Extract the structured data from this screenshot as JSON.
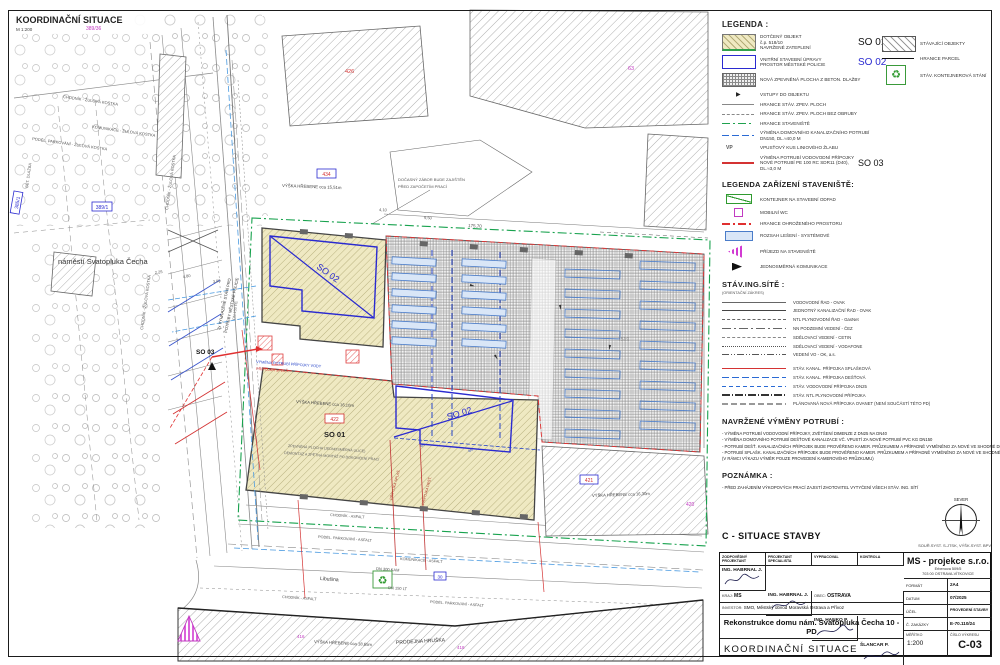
{
  "sheet": {
    "title": "KOORDINAČNÍ SITUACE",
    "scale": "M 1:200"
  },
  "icons": {
    "recycle": "♻",
    "entry_arrow": "▶"
  },
  "plan": {
    "labels": {
      "p389_36": "389/36",
      "p385_1": "385/1",
      "p389_1": "389/1",
      "p426": "426",
      "p434": "434",
      "p63": "63",
      "p422": "422",
      "p421": "421",
      "p420": "420",
      "p1519": "1519",
      "p416": "416",
      "p418": "418",
      "p30": "30",
      "chodnik_zk": "CHODNÍK - ŽULOVÁ KOSTKA",
      "komunikace_zk": "KOMUNIKACE - ŽULOVÁ KOSTKA",
      "podel_zk": "PODÉL. PARKOVÁNÍ - ŽULOVÁ KOSTKA",
      "bet_dlazba": "BET. DLAŽBA",
      "namesti": "náměstí Svatopluka Čecha",
      "vyhraz1": "2x VYHRAZENÉ STÁNÍ PRO",
      "vyhraz2": "POTŘEBY MĚSTSKÉ POLICIE",
      "so01": "SO 01",
      "so02": "SO 02",
      "so03": "SO 03",
      "vyska15": "VÝŠKA HŘEBENE cca 15,51m",
      "vyska16_10": "VÝŠKA HŘEBENE cca 16,10m",
      "vyska16_30": "VÝŠKA HŘEBENE cca 16,30m",
      "vyska18": "VÝŠKA HŘEBENE cca 18,65m",
      "prodejna": "PRODEJNA HRUŠKA",
      "docasny1": "DOČASNÝ ZÁBOR BUDE ZAJIŠTĚN",
      "docasny2": "PŘED ZAPOČETÍM PRACÍ",
      "vymena_vody": "VÝMĚNA POTRUBÍ PŘÍPOJKY VODY",
      "pripojka_splas": "PŘÍPOJKA SPLAŠ.",
      "pripojka_dest": "PŘÍPOJKA DEŠŤ.",
      "zpevnena1": "ZPEVNĚNÁ PLOCHA (JEDNOSMĚRNÁ ULICE)",
      "zpevnena2": "DEMONTÁŽ A ZPĚTNÁ MONTÁŽ PO DOKONČENÍ PRACÍ",
      "chodnik_asf": "CHODNÍK - ASFALT",
      "podel_asf": "PODÉL. PARKOVÁNÍ - ASFALT",
      "komunikace_asf": "KOMUNIKACE - ASFALT",
      "libusina": "Libušina",
      "dn300": "DN 300 KAM",
      "dn150": "DN 150 LT",
      "dn150pe": "DN 150 PE",
      "vp": "VP",
      "d410": "4,10",
      "d950": "9,50",
      "d17570": "175,70",
      "d225": "2,25",
      "d480": "4,80",
      "d300": "3,00"
    }
  },
  "legend": {
    "title": "LEGENDA :",
    "left": [
      {
        "l1": "DOTČENÝ OBJEKT",
        "l2": "č.p. 518/10",
        "l3": "NAVRŽENÉ ZATEPLENÍ",
        "tag": "SO 01"
      },
      {
        "l1": "VNITŘNÍ STAVEBNÍ ÚPRAVY",
        "l2": "PROSTOR MĚSTSKÉ POLICIE",
        "tag": "SO 02"
      },
      {
        "l1": "NOVÁ ZPEVNĚNÁ PLOCHA Z BETON. DLAŽBY"
      },
      {
        "l1": "VSTUPY DO OBJEKTU"
      },
      {
        "l1": "HRANICE STÁV. ZPEV. PLOCH"
      },
      {
        "l1": "HRANICE STÁV. ZPEV. PLOCH BEZ OBRUBY"
      },
      {
        "l1": "HRANICE STAVENIŠTĚ"
      },
      {
        "l1": "VÝMĚNA DOMOVNÍHO KANALIZAČNÍHO POTRUBÍ",
        "l2": "DN150, DL.≈40,0 M"
      },
      {
        "l1": "VPUSŤOVÝ KUS LINIOVÉHO ŽLABU"
      },
      {
        "l1": "VÝMĚNA POTRUBÍ VODOVODNÍ PŘÍPOJKY",
        "l2": "NOVÉ POTRUBÍ PE 100 RC SDR11 (D40), DL.≈3,0 M",
        "tag": "SO 03"
      }
    ],
    "right": [
      {
        "label": "STÁVAJÍCÍ OBJEKTY"
      },
      {
        "label": "HRANICE PARCEL"
      },
      {
        "label": "STÁV. KONTEJNEROVÁ STÁNÍ"
      }
    ]
  },
  "siteLegend": {
    "title": "LEGENDA ZAŘÍZENÍ STAVENIŠTĚ:",
    "items": [
      {
        "label": "KONTEJNER NA STAVEBNÍ ODPAD"
      },
      {
        "label": "MOBILNÍ WC"
      },
      {
        "label": "HRANICE OHROŽENÉHO PROSTORU"
      },
      {
        "label": "ROZSAH LEŠENÍ - SYSTÉMOVÉ"
      },
      {
        "label": "PŘÍJEZD NA STAVENIŠTĚ"
      },
      {
        "label": "JEDNOSMĚRNÁ KOMUNIKACE"
      }
    ]
  },
  "networks": {
    "title": "STÁV.ING.SÍTĚ :",
    "subtitle": "(ORIENTAČNÍ ZÁKRES)",
    "items": [
      {
        "label": "VODOVODNÍ ŘAD - OVAK"
      },
      {
        "label": "JEDNOTNÝ KANALIZAČNÍ ŘAD - OVAK"
      },
      {
        "label": "NTL PLYNOVODNÍ ŘAD - GasNet"
      },
      {
        "label": "NN PODZEMNÍ VEDENÍ - ČEZ"
      },
      {
        "label": "SDĚLOVACÍ VEDENÍ - CETIN"
      },
      {
        "label": "SDĚLOVACÍ VEDENÍ - VODAFONE"
      },
      {
        "label": "VEDENÍ VO - OK, a.s."
      },
      {
        "label": "STÁV. KANAL. PŘÍPOJKA SPLAŠKOVÁ"
      },
      {
        "label": "STÁV. KANAL. PŘÍPOJKA DEŠŤOVÁ"
      },
      {
        "label": "STÁV. VODOVODNÍ PŘÍPOJKA DN25"
      },
      {
        "label": "STÁV. NTL PLYNOVODNÍ PŘÍPOJKA"
      },
      {
        "label": "PLÁNOVANÁ NOVÁ PŘÍPOJKA OVANET (NENÍ SOUČÁSTÍ TÉTO PD)"
      }
    ]
  },
  "proposed": {
    "title": "NAVRŽENÉ VÝMĚNY POTRUBÍ :",
    "items": [
      "- VÝMĚNA POTRUBÍ VODOVODNÍ PŘÍPOJKY, ZVĚTŠENÍ DIMENZE Z DN25 NA DN40",
      "- VÝMĚNA DOMOVNÍHO POTRUBÍ DEŠŤOVÉ KANALIZACE VČ. VPUSTÍ ZA NOVÉ POTRUBÍ PVC KG DN150",
      "- POTRUBÍ DEŠŤ. KANALIZAČNÍCH PŘÍPOJEK BUDE PROVĚŘENO KAMER. PRŮZKUMEM A PŘÍPADNĚ VYMĚNĚNO ZA NOVÉ VE SHODNÉ DN",
      "- POTRUBÍ SPLAŠK. KANALIZAČNÍCH PŘÍPOJEK BUDE PROVĚŘENO KAMER. PRŮZKUMEM A PŘÍPADNĚ VYMĚNĚNO ZA NOVÉ VE SHODNÉ DN",
      "  (V RÁMCI VÝKAZU VÝMĚR POUZE PROVEDENÍ KAMEROVÉHO PRŮZKUMU)"
    ]
  },
  "note": {
    "title": "POZNÁMKA :",
    "items": [
      "- PŘED ZAHÁJENÍM VÝKOPOVÝCH PRACÍ ZAJISTÍ ZHOTOVITEL VYTYČENÍ VŠECH STÁV. ING. SÍTÍ"
    ]
  },
  "compass": {
    "label": "SEVER"
  },
  "titleblock": {
    "header": "C - SITUACE STAVBY",
    "coords": "SOUŘ.SYST. S-JTSK, VÝŠK.SYST. BPV",
    "roles": [
      {
        "a": "ZODPOVĚDNÝ",
        "b": "PROJEKTANT"
      },
      {
        "a": "PROJEKTANT",
        "b": "SPECIALISTA"
      },
      {
        "a": "VYPRACOVAL",
        "b": ""
      },
      {
        "a": "KONTROLA",
        "b": ""
      }
    ],
    "names": [
      "ING. HABRNAL J.",
      "ING. HABRNAL J.",
      "ING. HANKO P.",
      "ŠLANCAR P."
    ],
    "kraj_label": "KRAJ:",
    "kraj": "MS",
    "obec_label": "OBEC:",
    "obec": "OSTRAVA",
    "investor_label": "INVESTOR:",
    "investor": "SMO, Městský obvod Moravská Ostrava a Přívoz",
    "project": "Rekonstrukce domu nám.  Svatopluka Čecha 10 - PD",
    "project_sub": "náměstí Svatopluka Čecha 518/10, 702 00 Ostrava - Přívoz",
    "drawing": "KOORDINAČNÍ  SITUACE",
    "company": "MS - projekce s.r.o.",
    "company_addr1": "Erbenova 509/5",
    "company_addr2": "703 00 OSTRAVA-VÍTKOVICE",
    "rows": [
      {
        "label": "FORMÁT",
        "value": "2A4"
      },
      {
        "label": "DATUM",
        "value": "07/2025"
      },
      {
        "label": "ÚČEL",
        "value": "PROVEDENÍ STAVBY"
      },
      {
        "label": "Č. ZAKÁZKY",
        "value": "E-70.110/24"
      }
    ],
    "meritko_label": "MĚŘÍTKO",
    "meritko": "1:200",
    "cislo_label": "ČÍSLO VÝKRESU",
    "cislo": "C-03"
  }
}
